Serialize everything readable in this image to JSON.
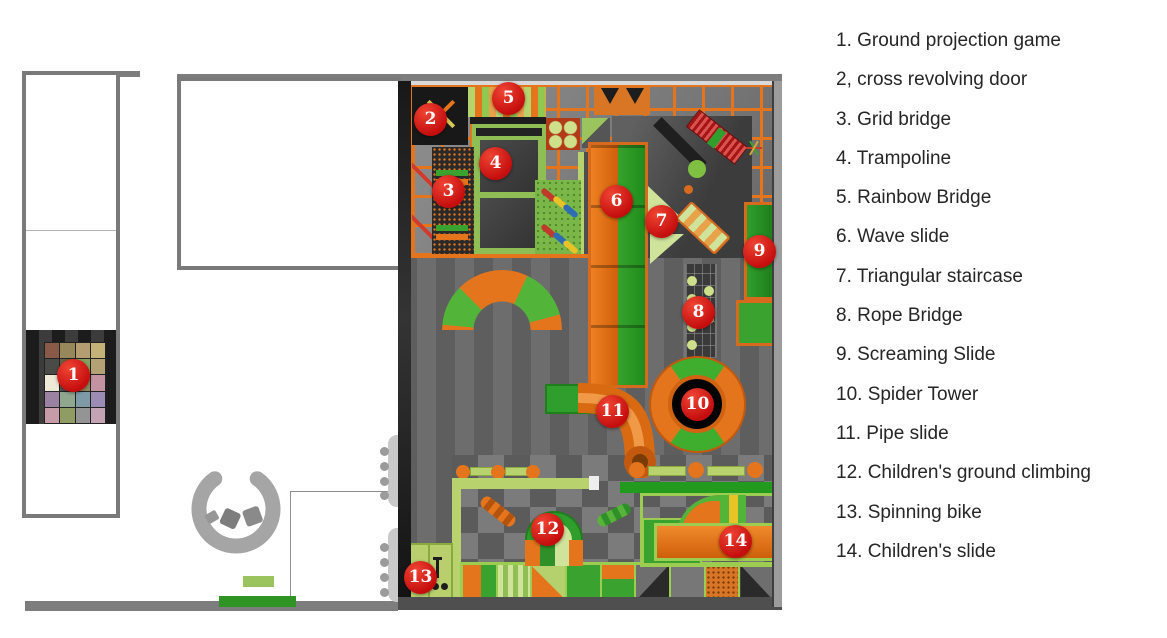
{
  "diagram": {
    "type": "indoor-playground-floor-plan",
    "legend": {
      "items": [
        {
          "num": "1",
          "text": "1. Ground projection game",
          "label": "Ground projection game"
        },
        {
          "num": "2",
          "text": "2, cross revolving door",
          "label": "cross revolving door"
        },
        {
          "num": "3",
          "text": "3. Grid bridge",
          "label": "Grid bridge"
        },
        {
          "num": "4",
          "text": "4. Trampoline",
          "label": "Trampoline"
        },
        {
          "num": "5",
          "text": "5. Rainbow Bridge",
          "label": "Rainbow Bridge"
        },
        {
          "num": "6",
          "text": "6. Wave slide",
          "label": "Wave slide"
        },
        {
          "num": "7",
          "text": "7. Triangular staircase",
          "label": "Triangular staircase"
        },
        {
          "num": "8",
          "text": "8. Rope Bridge",
          "label": "Rope Bridge"
        },
        {
          "num": "9",
          "text": "9. Screaming Slide",
          "label": "Screaming Slide"
        },
        {
          "num": "10",
          "text": "10. Spider Tower",
          "label": "Spider Tower"
        },
        {
          "num": "11",
          "text": "11. Pipe slide",
          "label": "Pipe slide"
        },
        {
          "num": "12",
          "text": "12. Children's ground climbing",
          "label": "Children's ground climbing"
        },
        {
          "num": "13",
          "text": "13. Spinning bike",
          "label": "Spinning bike"
        },
        {
          "num": "14",
          "text": "14. Children's slide",
          "label": "Children's slide"
        }
      ]
    },
    "markers": [
      {
        "num": "1",
        "x": 73,
        "y": 375,
        "label": "Ground projection game"
      },
      {
        "num": "2",
        "x": 430,
        "y": 119,
        "label": "cross revolving door"
      },
      {
        "num": "3",
        "x": 448,
        "y": 191,
        "label": "Grid bridge"
      },
      {
        "num": "4",
        "x": 495,
        "y": 163,
        "label": "Trampoline"
      },
      {
        "num": "5",
        "x": 508,
        "y": 98,
        "label": "Rainbow Bridge"
      },
      {
        "num": "6",
        "x": 616,
        "y": 201,
        "label": "Wave slide"
      },
      {
        "num": "7",
        "x": 661,
        "y": 221,
        "label": "Triangular staircase"
      },
      {
        "num": "8",
        "x": 698,
        "y": 312,
        "label": "Rope Bridge"
      },
      {
        "num": "9",
        "x": 759,
        "y": 251,
        "label": "Screaming Slide"
      },
      {
        "num": "10",
        "x": 697,
        "y": 404,
        "label": "Spider Tower"
      },
      {
        "num": "11",
        "x": 612,
        "y": 411,
        "label": "Pipe slide"
      },
      {
        "num": "12",
        "x": 547,
        "y": 529,
        "label": "Children's ground climbing"
      },
      {
        "num": "13",
        "x": 420,
        "y": 577,
        "label": "Spinning bike"
      },
      {
        "num": "14",
        "x": 735,
        "y": 541,
        "label": "Children's slide"
      }
    ],
    "palette": {
      "orange": "#e4751c",
      "orange-dark": "#c2590f",
      "green": "#2f9e2c",
      "green-bright": "#3aa32f",
      "green-light": "#b8d36e",
      "green-pale": "#cfe39a",
      "lime": "#9ccc50",
      "red": "#cc1313",
      "wall": "#7d7d7d"
    },
    "projection_tiles": [
      "#8a5a48",
      "#97885c",
      "#b59d72",
      "#c3b377",
      "#4a4a46",
      "#6d5d42",
      "#85a061",
      "#b3a273",
      "#efe9d8",
      "#56544e",
      "#8f8a5e",
      "#c493a2",
      "#9c82a2",
      "#8fa68f",
      "#7e9aa6",
      "#9a8cb5",
      "#c79ca8",
      "#8f9c64",
      "#949494",
      "#c4a4b4"
    ]
  }
}
